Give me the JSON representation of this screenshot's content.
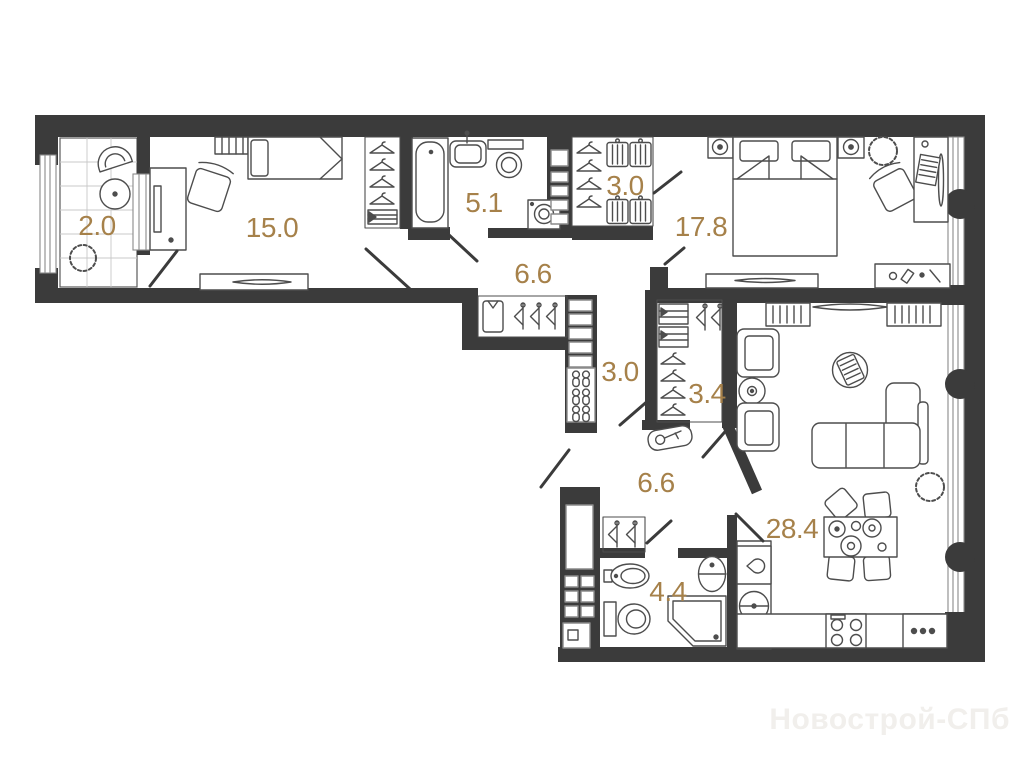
{
  "meta": {
    "type": "apartment-floor-plan",
    "watermark": "Новострой-СПб"
  },
  "colors": {
    "wall": "#3b3b3b",
    "furniture_line": "#4d4d4d",
    "window_line": "#8a8a8a",
    "tile_line": "#c8c8c8",
    "area_label": "#a6814a",
    "watermark": "#f1efec",
    "background": "#ffffff"
  },
  "rooms": [
    {
      "name": "balcony",
      "label": "2.0"
    },
    {
      "name": "bedroom-15",
      "label": "15.0"
    },
    {
      "name": "bathroom-5-1",
      "label": "5.1"
    },
    {
      "name": "wardrobe-3-0",
      "label": "3.0"
    },
    {
      "name": "bedroom-17-8",
      "label": "17.8"
    },
    {
      "name": "corridor-6-6-a",
      "label": "6.6"
    },
    {
      "name": "hallway-3-0",
      "label": "3.0"
    },
    {
      "name": "closet-3-4",
      "label": "3.4"
    },
    {
      "name": "corridor-6-6-b",
      "label": "6.6"
    },
    {
      "name": "kitchen-living-28-4",
      "label": "28.4"
    },
    {
      "name": "bathroom-4-4",
      "label": "4.4"
    }
  ]
}
